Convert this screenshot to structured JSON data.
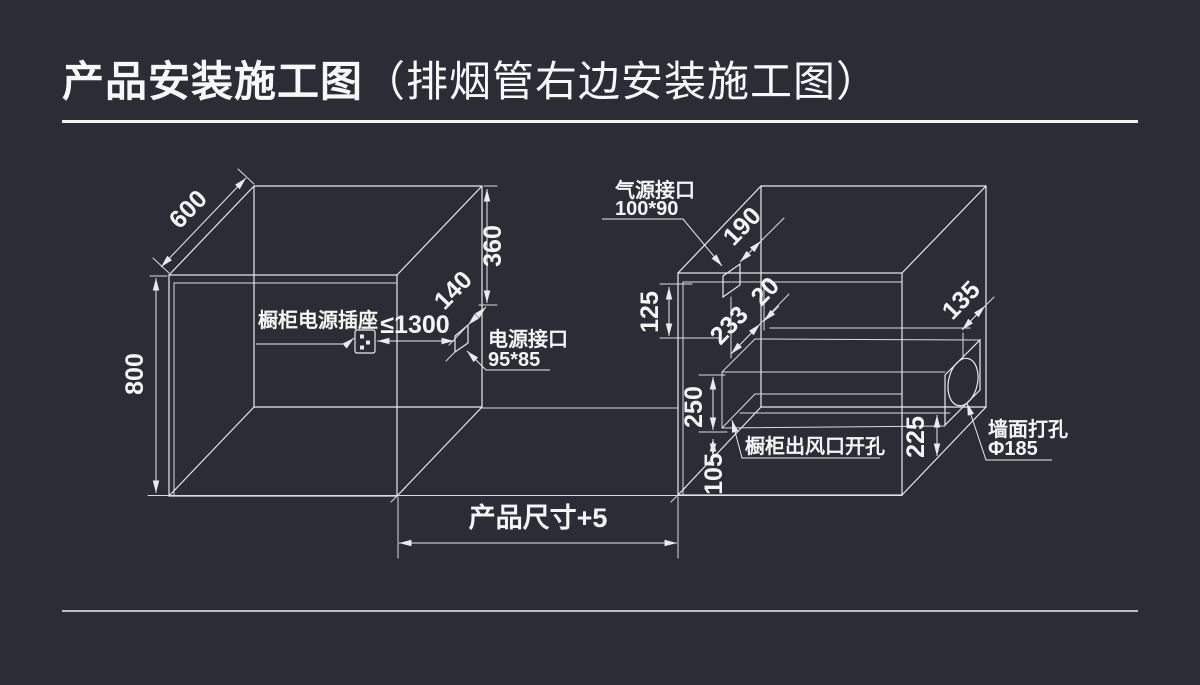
{
  "title": {
    "main": "产品安装施工图",
    "sub": "（排烟管右边安装施工图）"
  },
  "left_cabinet": {
    "dim_depth": "600",
    "dim_height": "800",
    "dim_top_to_port": "360",
    "dim_port_offset": "140",
    "dim_socket_distance": "≤1300",
    "socket_label": "橱柜电源插座",
    "power_port_label": "电源接口",
    "power_port_size": "95*85"
  },
  "right_cabinet": {
    "gas_port_label": "气源接口",
    "gas_port_size": "100*90",
    "dim_gas_offset": "190",
    "dim_gas_top": "125",
    "dim_duct_depth": "233",
    "dim_duct_gap": "20",
    "dim_hole_offset": "135",
    "dim_hole_bottom": "225",
    "dim_duct_height": "250",
    "dim_duct_bottom": "105",
    "outlet_label": "橱柜出风口开孔",
    "wall_hole_label": "墙面打孔",
    "wall_hole_size": "Φ185"
  },
  "footer": {
    "product_size_dim": "产品尺寸+5"
  },
  "colors": {
    "background": "#2b2d34",
    "line": "#e8eaec",
    "text": "#f4f5f6"
  }
}
